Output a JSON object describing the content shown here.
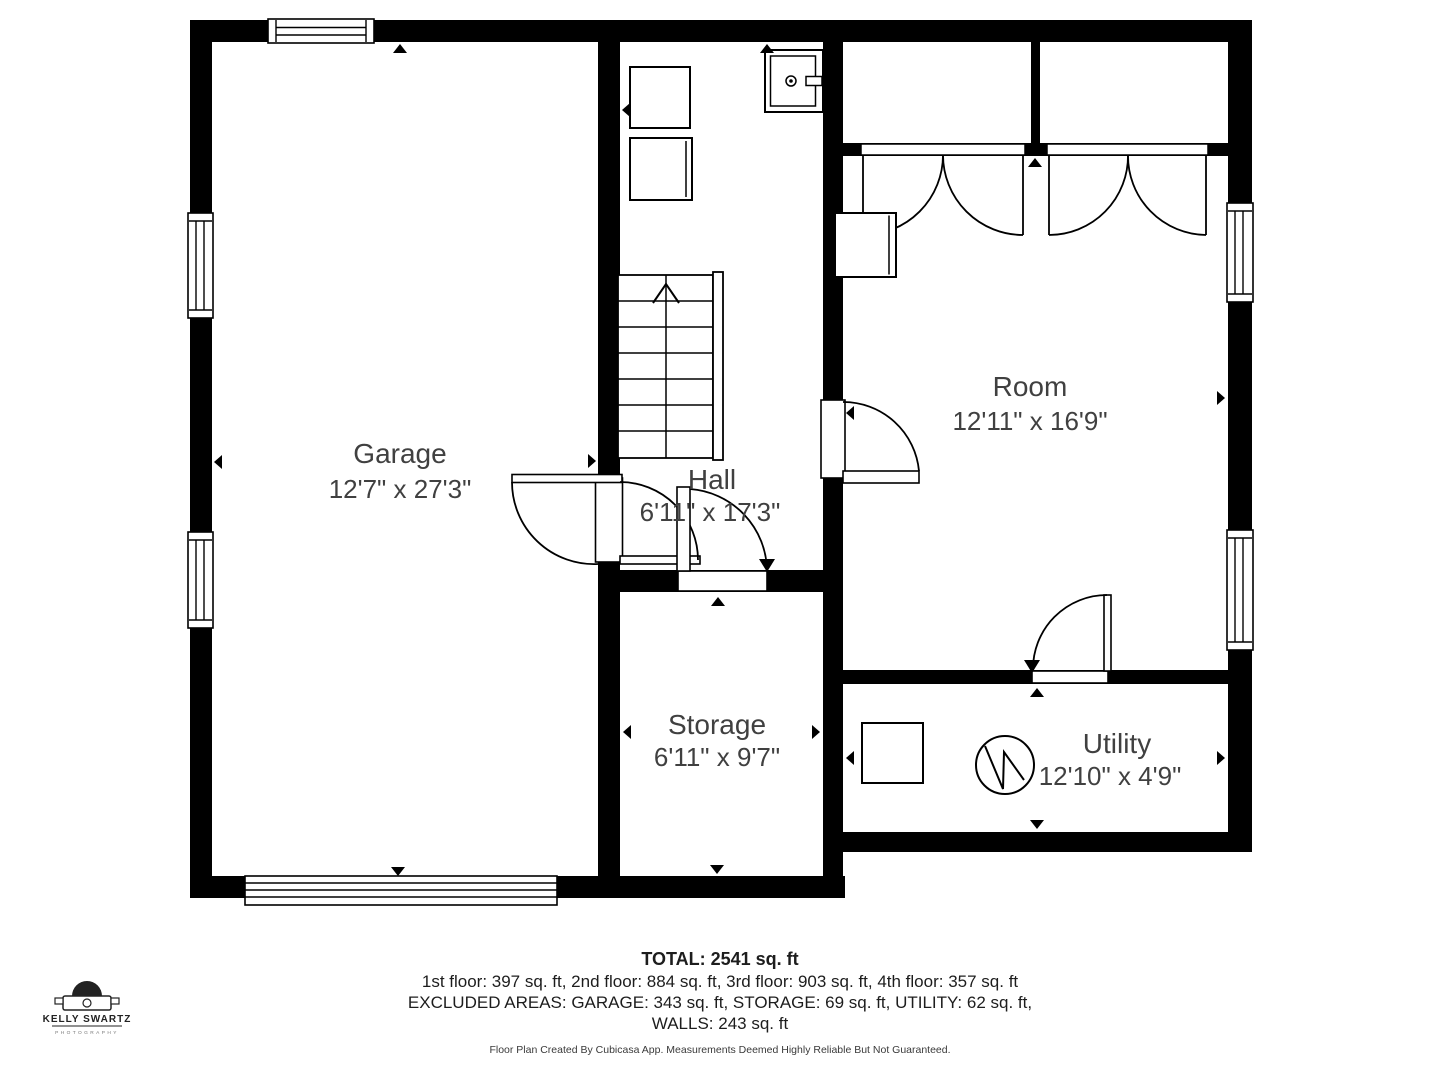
{
  "plan": {
    "rooms": [
      {
        "name": "Garage",
        "dims": "12'7\" x 27'3\""
      },
      {
        "name": "Hall",
        "dims": "6'11\" x 17'3\""
      },
      {
        "name": "Room",
        "dims": "12'11\" x 16'9\""
      },
      {
        "name": "Storage",
        "dims": "6'11\" x 9'7\""
      },
      {
        "name": "Utility",
        "dims": "12'10\" x 4'9\""
      }
    ],
    "icons": [
      "stairs-up-icon",
      "washer-icon",
      "dryer-icon",
      "utility-sink-icon",
      "water-heater-icon",
      "cabinet-icon",
      "door-swing-icon",
      "window-icon",
      "garage-door-icon",
      "dimension-marker-icon",
      "camera-logo-icon"
    ]
  },
  "summary": {
    "total": "TOTAL: 2541 sq. ft",
    "floors": "1st floor: 397 sq. ft, 2nd floor: 884 sq. ft, 3rd floor: 903 sq. ft, 4th floor: 357 sq. ft",
    "excluded": "EXCLUDED AREAS: GARAGE: 343 sq. ft, STORAGE: 69 sq. ft, UTILITY: 62 sq. ft,",
    "walls": "WALLS: 243 sq. ft",
    "disclaimer": "Floor Plan Created By Cubicasa App. Measurements Deemed Highly Reliable But Not Guaranteed."
  },
  "branding": {
    "name": "KELLY SWARTZ",
    "tagline": "PHOTOGRAPHY"
  },
  "colors": {
    "wall": "#000000",
    "background": "#ffffff",
    "room_label": "#404040",
    "summary_text": "#1d1d1d",
    "disclaimer_text": "#3a3a3a",
    "logo": "#222222"
  }
}
